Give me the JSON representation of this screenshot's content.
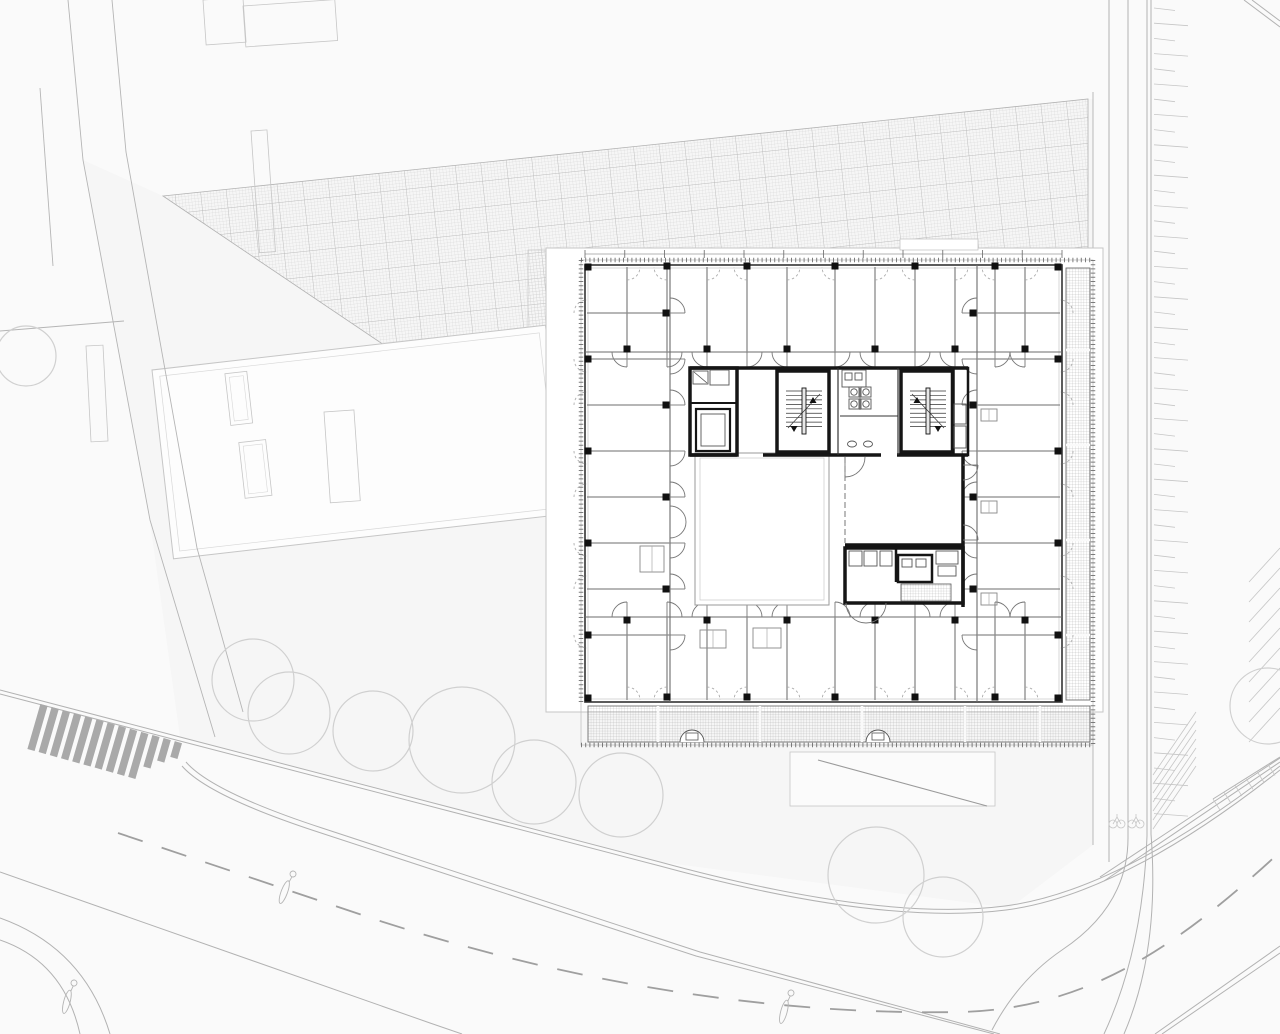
{
  "canvas": {
    "w": 1280,
    "h": 1034
  },
  "colors": {
    "bg": "#fafafa",
    "site_fill": "#f6f6f6",
    "white": "#ffffff",
    "hatch_fine": "#cfcfcf",
    "hatch_bold": "#b2b2b2",
    "site_line": "#b5b5b5",
    "neighbor_line": "#c6c6c6",
    "tree_line": "#d0d0d0",
    "stripe": "#a9a9a9",
    "road_line": "#b2b2b2",
    "road_dash": "#9f9f9f",
    "park_line": "#c6c6c6",
    "slab_line": "#c6c6c6",
    "wall_dark": "#3f3f3f",
    "wall_mid": "#6b6b6b",
    "wall_light": "#9a9a9a",
    "glass": "#bdbdbd",
    "core_black": "#151515",
    "fixture": "#555555",
    "door_arc": "#767676",
    "door_dash": "#a5a5a5",
    "tick": "#666666",
    "balcony_grid": "#9a9a9a",
    "column": "#111111"
  },
  "site": {
    "site_polygon": [
      [
        83,
        160
      ],
      [
        163,
        196
      ],
      [
        1088,
        99
      ],
      [
        1093,
        99
      ],
      [
        1093,
        845
      ],
      [
        1010,
        908
      ],
      [
        660,
        862
      ],
      [
        180,
        737
      ],
      [
        150,
        522
      ]
    ],
    "paving_polygon": [
      [
        163,
        196
      ],
      [
        1088,
        99
      ],
      [
        1088,
        253
      ],
      [
        548,
        253
      ],
      [
        548,
        332
      ],
      [
        430,
        376
      ]
    ],
    "paving_strip": [
      528,
      250,
      28,
      85
    ],
    "property_lines": [
      [
        [
          68,
          0
        ],
        [
          83,
          160
        ],
        [
          150,
          520
        ],
        [
          215,
          737
        ]
      ],
      [
        [
          112,
          0
        ],
        [
          126,
          152
        ],
        [
          197,
          548
        ],
        [
          243,
          712
        ]
      ],
      [
        [
          40,
          88
        ],
        [
          53,
          266
        ]
      ],
      [
        [
          0,
          331
        ],
        [
          124,
          321
        ]
      ]
    ],
    "neighbor_rects": [
      [
        203,
        0,
        40,
        45,
        -4
      ],
      [
        243,
        6,
        92,
        41,
        -4
      ],
      [
        251,
        131,
        16,
        122,
        -4
      ],
      [
        86,
        346,
        17,
        96,
        -3
      ],
      [
        324,
        412,
        30,
        91,
        -4
      ]
    ],
    "roof": {
      "x": 152,
      "y": 370,
      "w": 396,
      "h": 190,
      "rot": -6.5,
      "inner": 7,
      "chimneys": [
        [
          72,
          12,
          22,
          52
        ],
        [
          78,
          82,
          27,
          56
        ]
      ]
    },
    "trees": [
      [
        253,
        680,
        41
      ],
      [
        289,
        713,
        41
      ],
      [
        373,
        731,
        40
      ],
      [
        462,
        740,
        53
      ],
      [
        534,
        782,
        42
      ],
      [
        621,
        795,
        42
      ],
      [
        876,
        875,
        48
      ],
      [
        943,
        917,
        40
      ],
      [
        1268,
        706,
        38
      ],
      [
        26,
        356,
        30
      ]
    ],
    "lamps": [
      [
        293,
        874,
        20
      ],
      [
        791,
        993,
        15
      ],
      [
        74,
        983,
        15
      ]
    ],
    "crosswalk": {
      "x0": 44,
      "y0": 705,
      "dx": 11.2,
      "dy": 3.1,
      "n": 13,
      "vx": -13,
      "vy": 45,
      "w": 7.5
    },
    "roads_solid": [
      "M 0,690 L 180,737 L 660,862 Q 880,922 1005,906 Q 1120,891 1280,766",
      "M 0,694 L 180,741 L 660,866 Q 880,926 1006,910 Q 1122,895 1280,770",
      "M 186,762 Q 212,792 322,828 L 700,952 L 1000,1034",
      "M 182,766 Q 208,796 318,832 L 696,956 L 994,1034",
      "M 0,872 L 430,1023 L 462,1034",
      "M 0,940 Q 64,962 80,1034",
      "M 0,918 Q 84,948 110,1034",
      "M 1128,0 L 1128,838 Q 1128,906 1062,950 Q 1018,980 992,1030",
      "M 1109,0 L 1109,862",
      "M 1147,0 L 1147,836",
      "M 1151,0 L 1151,834",
      "M 1147,836 Q 1143,950 1104,1034",
      "M 1151,834 Q 1160,950 1124,1034",
      "M 1100,877 L 1280,758",
      "M 1104,881 L 1280,762",
      "M 1213,799 L 1280,757",
      "M 1155,1034 L 1280,946",
      "M 1162,1034 L 1280,953",
      "M 1252,0 L 1280,21",
      "M 1244,0 L 1280,27"
    ],
    "roads_dashed": [
      "M 118,833 L 377,920 C 600,992 800,1015 960,1012 C 1090,1009 1180,944 1280,852"
    ],
    "vertical_street_line": [
      1093,
      92,
      845
    ],
    "park_ticks": {
      "x": 1154,
      "y0": 8,
      "y1": 828,
      "step": 15.2,
      "len_a": 21,
      "len_b": 34,
      "slope": 2.5
    },
    "stalls_corner": {
      "x0": 1153,
      "y0": 775,
      "dy": 9,
      "n": 7,
      "vx": 43,
      "vy": -63
    },
    "stalls_right": {
      "x0": 1249,
      "y0": 582,
      "dy": 20,
      "n": 9,
      "vx": 31,
      "vy": -34
    },
    "edge_ticks": {
      "px": 1213,
      "py": 799,
      "ux": 11.0,
      "uy": -6.9,
      "n": 6,
      "vx": 7,
      "vy": 11
    },
    "bikes": [
      [
        1117,
        821
      ],
      [
        1136,
        821
      ]
    ]
  },
  "slab": {
    "rect": [
      546,
      248,
      557,
      464
    ],
    "step": [
      900,
      239,
      78,
      11
    ],
    "ramp": {
      "rect": [
        790,
        752,
        205,
        54
      ],
      "diag": [
        818,
        760,
        987,
        806
      ]
    }
  },
  "building": {
    "tick_frame": [
      581,
      260,
      512,
      485
    ],
    "facade": [
      585,
      265,
      477,
      437
    ],
    "inner_glass": [
      588,
      268,
      471,
      431
    ],
    "dim_ticks": {
      "y": 254,
      "x0": 585,
      "x1": 1062,
      "step": 39.75
    },
    "bands": {
      "top": {
        "o": "h",
        "facade": 267,
        "inner": 352,
        "lo": 585,
        "hi": 1062,
        "dividers": [
          627,
          667,
          707,
          747,
          787,
          835,
          875,
          915,
          955,
          995,
          1025
        ]
      },
      "bottom": {
        "o": "h",
        "facade": 700,
        "inner": 617,
        "lo": 585,
        "hi": 1062,
        "dividers": [
          627,
          667,
          707,
          747,
          787,
          835,
          875,
          915,
          955,
          995,
          1025
        ]
      },
      "left": {
        "o": "v",
        "facade": 587,
        "inner": 670,
        "lo": 265,
        "hi": 702,
        "dividers": [
          313,
          359,
          405,
          451,
          497,
          543,
          589,
          635
        ]
      },
      "right": {
        "o": "v",
        "facade": 1060,
        "inner": 977,
        "lo": 265,
        "hi": 702,
        "dividers": [
          313,
          359,
          405,
          451,
          497,
          543,
          589,
          635
        ]
      }
    },
    "columns": {
      "size": 7,
      "top_facade": {
        "y": 266,
        "xs": [
          667,
          747,
          835,
          915,
          995
        ]
      },
      "top_corridor": {
        "y": 349,
        "xs": [
          627,
          707,
          787,
          875,
          955,
          1025
        ]
      },
      "bot_facade": {
        "y": 697,
        "xs": [
          667,
          747,
          835,
          915,
          995
        ]
      },
      "bot_corridor": {
        "y": 620,
        "xs": [
          627,
          707,
          787,
          875,
          955,
          1025
        ]
      },
      "left_facade": {
        "x": 588,
        "ys": [
          359,
          451,
          543,
          635
        ]
      },
      "left_corridor": {
        "x": 666,
        "ys": [
          313,
          405,
          497,
          589
        ]
      },
      "right_facade": {
        "x": 1058,
        "ys": [
          359,
          451,
          543,
          635
        ]
      },
      "right_corridor": {
        "x": 973,
        "ys": [
          313,
          405,
          497,
          589
        ]
      },
      "corners": [
        [
          588,
          267
        ],
        [
          1058,
          267
        ],
        [
          588,
          698
        ],
        [
          1058,
          698
        ]
      ]
    },
    "courtyard": {
      "outer": [
        695,
        453,
        134,
        152
      ],
      "inner": [
        700,
        458,
        124,
        142
      ]
    },
    "balcony_bottom": {
      "rect": [
        588,
        706,
        502,
        36
      ],
      "dividers": [
        658,
        760,
        862,
        965,
        1040
      ],
      "stairs": [
        [
          692,
          742
        ],
        [
          878,
          742
        ]
      ]
    },
    "balcony_right": {
      "rect": [
        1066,
        268,
        24,
        432
      ],
      "dividers": [
        350,
        445,
        540,
        635
      ]
    },
    "core": {
      "top_wall": [
        690,
        368,
        968,
        368
      ],
      "bottom_wall_segs": [
        [
          690,
          455,
          737,
          455
        ],
        [
          763,
          455,
          881,
          455
        ],
        [
          897,
          455,
          968,
          455
        ]
      ],
      "elev_room": {
        "rect": [
          690,
          368,
          47,
          87
        ],
        "mid_y": 403,
        "shaft": [
          696,
          409,
          34,
          42
        ],
        "car": [
          701,
          414,
          24,
          32
        ],
        "fix": [
          [
            693,
            371,
            15,
            13
          ],
          [
            710,
            370,
            19,
            15
          ]
        ],
        "diag": [
          694,
          372,
          707,
          383
        ]
      },
      "stair_w": {
        "rect": [
          777,
          371,
          52,
          81
        ],
        "tx0": 786,
        "tx1": 822,
        "ty0": 391,
        "ty1": 431,
        "tstep": 4.45,
        "rail": [
          802,
          388,
          4,
          46
        ],
        "diag": [
          788,
          428,
          820,
          394
        ],
        "up": [
          813,
          403
        ],
        "down": [
          794,
          426
        ]
      },
      "stair_e": {
        "rect": [
          901,
          371,
          52,
          81
        ],
        "tx0": 910,
        "tx1": 946,
        "ty0": 391,
        "ty1": 431,
        "tstep": 4.45,
        "rail": [
          926,
          388,
          4,
          46
        ],
        "diag": [
          912,
          394,
          944,
          428
        ],
        "up": [
          917,
          403
        ],
        "down": [
          938,
          426
        ]
      },
      "wc": {
        "lx": 838,
        "rx": 898,
        "counter": [
          842,
          370,
          24,
          17
        ],
        "sinks": [
          [
            845,
            373,
            7,
            7
          ],
          [
            855,
            373,
            7,
            7
          ]
        ],
        "toilets": [
          [
            854,
            392
          ],
          [
            866,
            392
          ],
          [
            854,
            404
          ],
          [
            866,
            404
          ]
        ],
        "part": [
          860,
          388,
          860,
          410
        ],
        "mid_wall": [
          840,
          416,
          898,
          416
        ],
        "basins": [
          [
            852,
            444
          ],
          [
            868,
            444
          ]
        ]
      },
      "annex": {
        "rect": [
          952,
          368,
          16,
          87
        ],
        "boxes": [
          [
            954,
            404,
            12,
            20
          ],
          [
            954,
            426,
            12,
            22
          ]
        ]
      },
      "entry_arcs": [
        [
          670,
          506,
          16,
          1
        ],
        [
          670,
          538,
          16,
          0
        ]
      ]
    },
    "meeting": {
      "dash_wall": [
        845,
        457,
        845,
        543
      ],
      "right_wall": [
        963,
        455,
        963,
        607
      ],
      "bottom_wall": [
        845,
        545,
        963,
        545
      ]
    },
    "wc_cluster": {
      "rect": [
        845,
        548,
        118,
        55
      ],
      "div": [
        896,
        548,
        896,
        582
      ],
      "shaft": [
        898,
        555,
        34,
        27
      ],
      "shaft_boxes": [
        [
          902,
          559,
          10,
          8
        ],
        [
          916,
          559,
          10,
          8
        ]
      ],
      "fixtures": [
        [
          849,
          551,
          13,
          15
        ],
        [
          864,
          551,
          13,
          15
        ],
        [
          880,
          551,
          12,
          15
        ],
        [
          936,
          551,
          22,
          13
        ],
        [
          938,
          566,
          18,
          10
        ]
      ],
      "mat": [
        901,
        584,
        50,
        17
      ],
      "door_arc": [
        846,
        603,
        886,
        603
      ]
    },
    "closets": [
      [
        640,
        546,
        24,
        26
      ],
      [
        753,
        628,
        28,
        20
      ],
      [
        981,
        409,
        16,
        12
      ],
      [
        981,
        501,
        16,
        12
      ],
      [
        981,
        593,
        16,
        12
      ],
      [
        700,
        630,
        26,
        18
      ]
    ]
  }
}
